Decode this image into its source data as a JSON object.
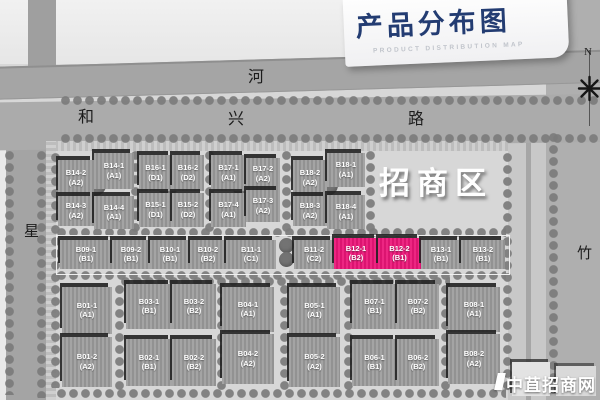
{
  "header": {
    "title": "产品分布图",
    "subtitle": "PRODUCT DISTRIBUTION MAP"
  },
  "zone": {
    "label": "招商区"
  },
  "compass": {
    "north": "N"
  },
  "roads": {
    "north": "河",
    "main": [
      "和",
      "兴",
      "路"
    ],
    "west": "星",
    "east": "竹"
  },
  "watermark": {
    "text": "中苴招商网"
  },
  "colors": {
    "highlight_pink": "#ec1578",
    "title_navy": "#233c72",
    "building_gray": "#9d9d9d",
    "road_gray": "#a8a8a8",
    "site_gray": "#d7d7d7",
    "zone_text": "#ffffff"
  },
  "buildings": [
    {
      "id": "B14-1",
      "unit": "(A1)",
      "x": 94,
      "y": 153,
      "w": 40,
      "h": 36,
      "hl": false
    },
    {
      "id": "B14-2",
      "unit": "(A2)",
      "x": 58,
      "y": 160,
      "w": 36,
      "h": 36,
      "hl": false
    },
    {
      "id": "B14-3",
      "unit": "(A2)",
      "x": 58,
      "y": 196,
      "w": 36,
      "h": 30,
      "hl": false
    },
    {
      "id": "B14-4",
      "unit": "(A1)",
      "x": 94,
      "y": 196,
      "w": 40,
      "h": 33,
      "hl": false
    },
    {
      "id": "B16-1",
      "unit": "(D1)",
      "x": 139,
      "y": 155,
      "w": 33,
      "h": 36,
      "hl": false
    },
    {
      "id": "B16-2",
      "unit": "(D2)",
      "x": 172,
      "y": 155,
      "w": 32,
      "h": 36,
      "hl": false
    },
    {
      "id": "B15-1",
      "unit": "(D1)",
      "x": 139,
      "y": 193,
      "w": 33,
      "h": 34,
      "hl": false
    },
    {
      "id": "B15-2",
      "unit": "(D2)",
      "x": 172,
      "y": 193,
      "w": 32,
      "h": 34,
      "hl": false
    },
    {
      "id": "B17-1",
      "unit": "(A1)",
      "x": 211,
      "y": 155,
      "w": 35,
      "h": 36,
      "hl": false
    },
    {
      "id": "B17-2",
      "unit": "(A2)",
      "x": 246,
      "y": 158,
      "w": 34,
      "h": 32,
      "hl": false
    },
    {
      "id": "B17-4",
      "unit": "(A1)",
      "x": 211,
      "y": 193,
      "w": 35,
      "h": 34,
      "hl": false
    },
    {
      "id": "B17-3",
      "unit": "(A2)",
      "x": 246,
      "y": 190,
      "w": 34,
      "h": 32,
      "hl": false
    },
    {
      "id": "B18-2",
      "unit": "(A2)",
      "x": 293,
      "y": 160,
      "w": 34,
      "h": 36,
      "hl": false
    },
    {
      "id": "B18-1",
      "unit": "(A1)",
      "x": 327,
      "y": 153,
      "w": 38,
      "h": 34,
      "hl": false
    },
    {
      "id": "B18-3",
      "unit": "(A2)",
      "x": 293,
      "y": 196,
      "w": 34,
      "h": 30,
      "hl": false
    },
    {
      "id": "B18-4",
      "unit": "(A1)",
      "x": 327,
      "y": 195,
      "w": 38,
      "h": 34,
      "hl": false
    },
    {
      "id": "B09-1",
      "unit": "(B1)",
      "x": 60,
      "y": 240,
      "w": 52,
      "h": 29,
      "hl": false
    },
    {
      "id": "B09-2",
      "unit": "(B1)",
      "x": 112,
      "y": 240,
      "w": 38,
      "h": 29,
      "hl": false
    },
    {
      "id": "B10-1",
      "unit": "(B1)",
      "x": 150,
      "y": 240,
      "w": 40,
      "h": 29,
      "hl": false
    },
    {
      "id": "B10-2",
      "unit": "(B2)",
      "x": 190,
      "y": 240,
      "w": 36,
      "h": 29,
      "hl": false
    },
    {
      "id": "B11-1",
      "unit": "(C1)",
      "x": 226,
      "y": 240,
      "w": 50,
      "h": 29,
      "hl": false
    },
    {
      "id": "B11-2",
      "unit": "(C2)",
      "x": 294,
      "y": 240,
      "w": 40,
      "h": 29,
      "hl": false
    },
    {
      "id": "B12-1",
      "unit": "(B2)",
      "x": 334,
      "y": 238,
      "w": 44,
      "h": 31,
      "hl": true
    },
    {
      "id": "B12-2",
      "unit": "(B1)",
      "x": 378,
      "y": 238,
      "w": 43,
      "h": 31,
      "hl": true
    },
    {
      "id": "B13-1",
      "unit": "(B1)",
      "x": 421,
      "y": 240,
      "w": 40,
      "h": 29,
      "hl": false
    },
    {
      "id": "B13-2",
      "unit": "(B1)",
      "x": 461,
      "y": 240,
      "w": 44,
      "h": 29,
      "hl": false
    },
    {
      "id": "B01-1",
      "unit": "(A1)",
      "x": 62,
      "y": 287,
      "w": 50,
      "h": 47,
      "hl": false
    },
    {
      "id": "B01-2",
      "unit": "(A2)",
      "x": 62,
      "y": 337,
      "w": 50,
      "h": 50,
      "hl": false
    },
    {
      "id": "B03-1",
      "unit": "(B1)",
      "x": 126,
      "y": 284,
      "w": 46,
      "h": 45,
      "hl": false
    },
    {
      "id": "B03-2",
      "unit": "(B2)",
      "x": 172,
      "y": 284,
      "w": 44,
      "h": 45,
      "hl": false
    },
    {
      "id": "B02-1",
      "unit": "(B1)",
      "x": 126,
      "y": 339,
      "w": 46,
      "h": 47,
      "hl": false
    },
    {
      "id": "B02-2",
      "unit": "(B2)",
      "x": 172,
      "y": 339,
      "w": 44,
      "h": 47,
      "hl": false
    },
    {
      "id": "B04-1",
      "unit": "(A1)",
      "x": 222,
      "y": 287,
      "w": 52,
      "h": 45,
      "hl": false
    },
    {
      "id": "B04-2",
      "unit": "(A2)",
      "x": 222,
      "y": 334,
      "w": 52,
      "h": 50,
      "hl": false
    },
    {
      "id": "B05-1",
      "unit": "(A1)",
      "x": 289,
      "y": 287,
      "w": 51,
      "h": 47,
      "hl": false
    },
    {
      "id": "B05-2",
      "unit": "(A2)",
      "x": 289,
      "y": 337,
      "w": 51,
      "h": 50,
      "hl": false
    },
    {
      "id": "B07-1",
      "unit": "(B1)",
      "x": 352,
      "y": 284,
      "w": 45,
      "h": 45,
      "hl": false
    },
    {
      "id": "B07-2",
      "unit": "(B2)",
      "x": 397,
      "y": 284,
      "w": 42,
      "h": 45,
      "hl": false
    },
    {
      "id": "B06-1",
      "unit": "(B1)",
      "x": 352,
      "y": 339,
      "w": 45,
      "h": 47,
      "hl": false
    },
    {
      "id": "B06-2",
      "unit": "(B2)",
      "x": 397,
      "y": 339,
      "w": 42,
      "h": 47,
      "hl": false
    },
    {
      "id": "B08-1",
      "unit": "(A1)",
      "x": 448,
      "y": 287,
      "w": 52,
      "h": 45,
      "hl": false
    },
    {
      "id": "B08-2",
      "unit": "(A2)",
      "x": 448,
      "y": 334,
      "w": 52,
      "h": 50,
      "hl": false
    }
  ]
}
